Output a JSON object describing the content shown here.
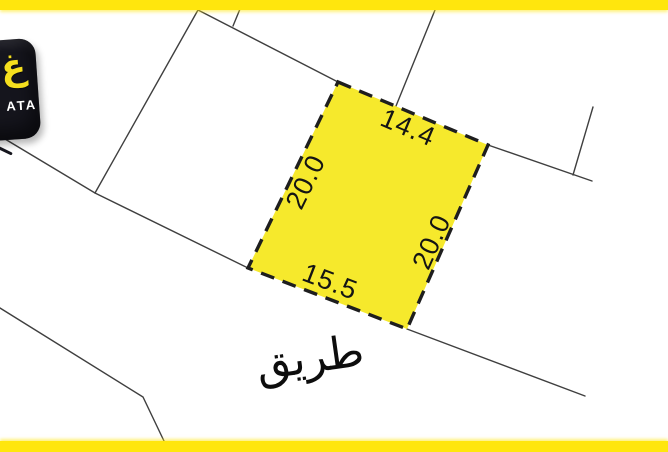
{
  "canvas": {
    "width": 668,
    "height": 452,
    "background": "#ffffff"
  },
  "accent_stripes": {
    "color": "#ffe60d"
  },
  "logo": {
    "badge_color": "#15151d",
    "emblem_text": "غ",
    "emblem_color": "#f5df1e",
    "caption": "ATA",
    "caption_color": "#ffffff"
  },
  "parcel": {
    "fill": "#f6e92c",
    "border_color": "#1e1e1e",
    "labels": {
      "top": "14.4",
      "right": "20.0",
      "bottom": "15.5",
      "left": "20.0"
    }
  },
  "road": {
    "label": "طريق"
  },
  "boundary_lines": {
    "color": "#3f3f3f"
  }
}
